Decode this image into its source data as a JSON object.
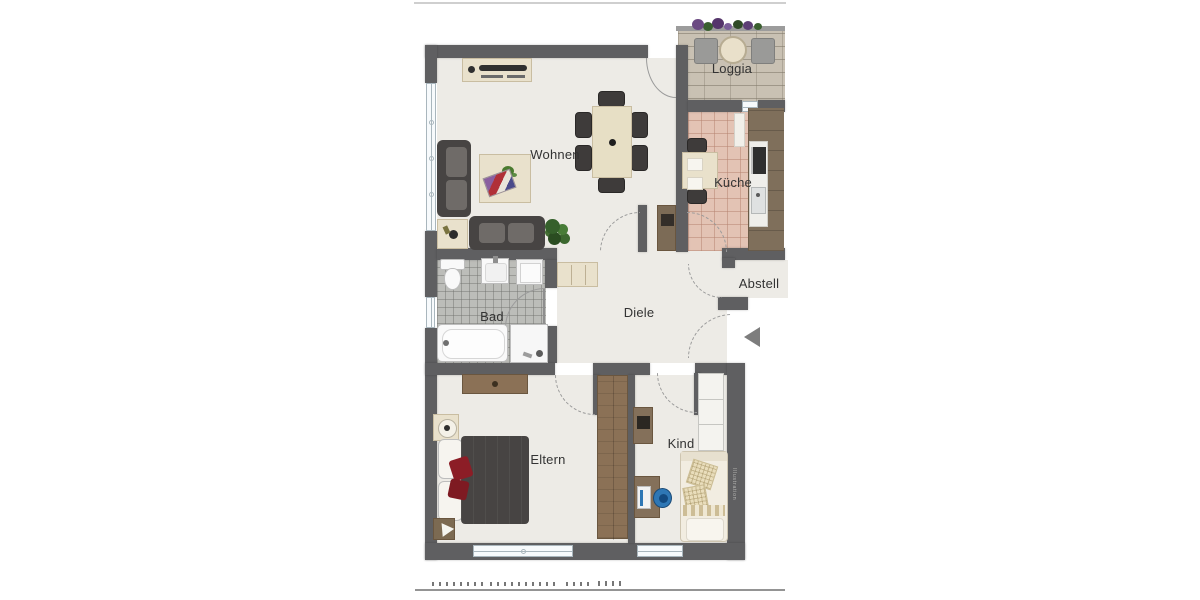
{
  "meta": {
    "type": "apartment-floor-plan",
    "language": "de"
  },
  "rooms": {
    "wohnen": {
      "label": "Wohnen"
    },
    "loggia": {
      "label": "Loggia"
    },
    "kueche": {
      "label": "Küche"
    },
    "bad": {
      "label": "Bad"
    },
    "diele": {
      "label": "Diele"
    },
    "abstell": {
      "label": "Abstell"
    },
    "eltern": {
      "label": "Eltern"
    },
    "kind": {
      "label": "Kind"
    }
  },
  "watermark": {
    "vertical_text": "Illustration"
  },
  "colors": {
    "wall": "#5f5f61",
    "floor": "#edebe6",
    "bad_tile": "#bcbdb9",
    "kitchen_tile": "#e3c3b4",
    "loggia_stone": "#c9c1b3",
    "wood": "#8b7156",
    "wood_dark": "#6a563f",
    "dark_furniture": "#474443",
    "cushion": "#6f6b68",
    "beige": "#e9e1cc",
    "beige_border": "#c9bda1",
    "red_accent": "#8c1d26",
    "plant_green": "#3a6a2d",
    "blue_chair": "#2e77b5",
    "window_glass": "#f7fafc",
    "window_frame": "#a9b6bd",
    "fixture_white": "#f9f9f9",
    "label_text": "#333333",
    "arc_line": "#9a9a9a",
    "entry_arrow": "#7d7d7d",
    "page_rule_top": "#cfcfcf",
    "page_rule_bottom": "#949494"
  }
}
